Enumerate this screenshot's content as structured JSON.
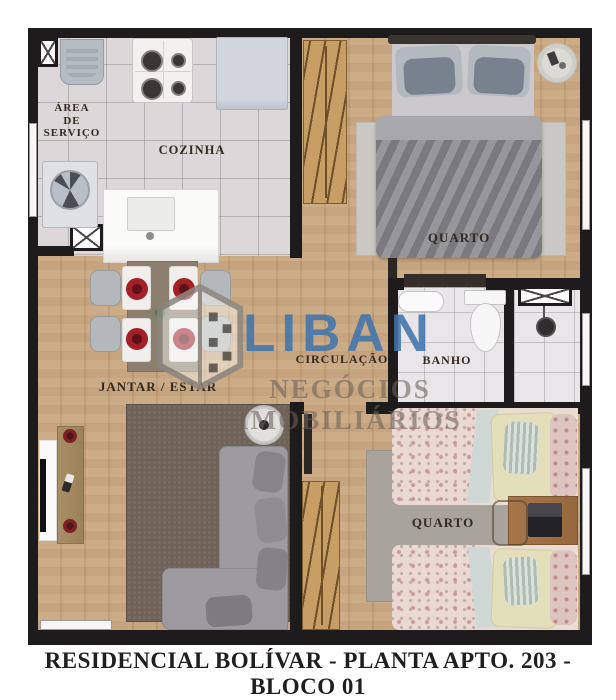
{
  "page": {
    "caption": "RESIDENCIAL BOLÍVAR - PLANTA APTO. 203 - BLOCO 01"
  },
  "rooms": {
    "service_area": {
      "label": "ÁREA\nDE\nSERVIÇO"
    },
    "kitchen": {
      "label": "COZINHA"
    },
    "bedroom_top": {
      "label": "QUARTO"
    },
    "circulation": {
      "label": "CIRCULAÇÃO"
    },
    "bathroom": {
      "label": "BANHO"
    },
    "living_dining": {
      "label": "JANTAR / ESTAR"
    },
    "bedroom_bottom": {
      "label": "QUARTO"
    }
  },
  "watermark": {
    "brand": "LIBAN",
    "tagline": "NEGÓCIOS IMOBILIÁRIOS",
    "logo_icon": "building-icon"
  },
  "colors": {
    "brand_blue": "#4076ac",
    "wall": "#1d1b1c",
    "wood_floor": "#c6a37b",
    "kitchen_tile": "#dcd8da",
    "bathroom_tile": "#e8e6e8",
    "caption_text": "#201e1e"
  }
}
